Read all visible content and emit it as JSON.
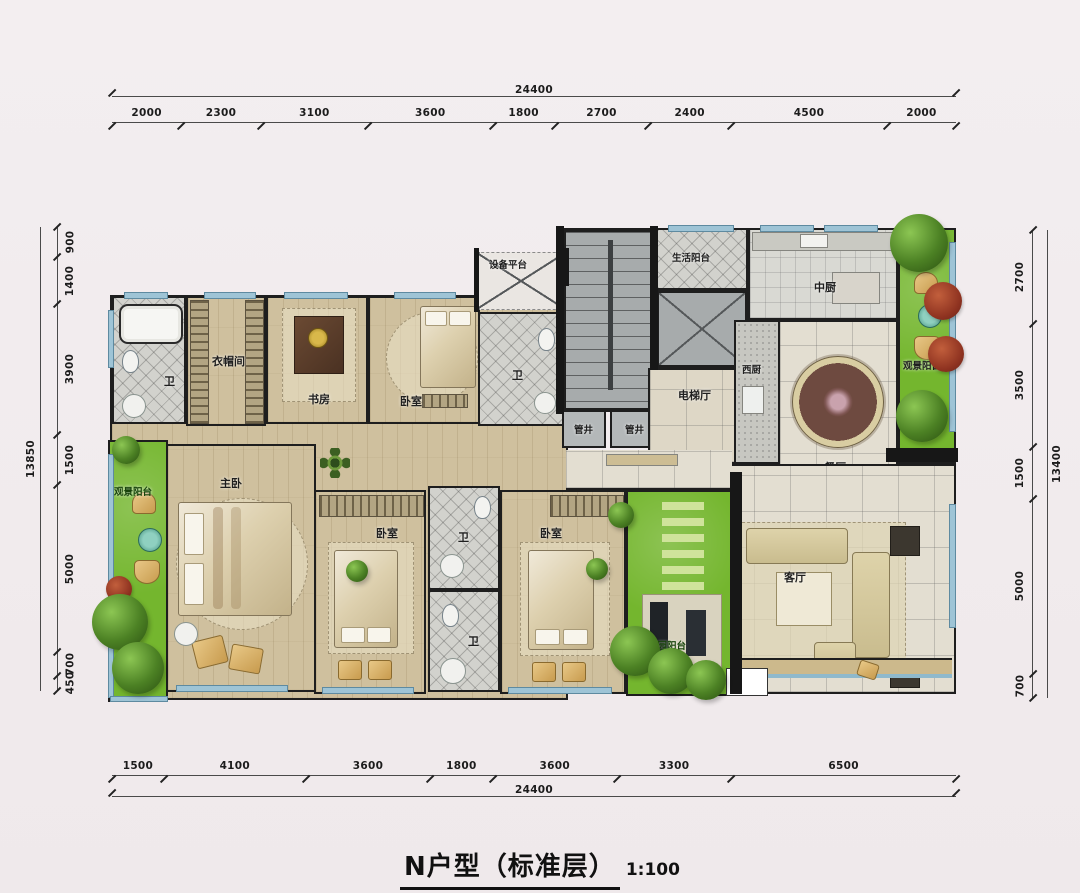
{
  "title": {
    "name": "N户型（标准层）",
    "scale": "1:100"
  },
  "dims": {
    "top": {
      "total": "24400",
      "segs": [
        "2000",
        "2300",
        "3100",
        "3600",
        "1800",
        "2700",
        "2400",
        "4500",
        "2000"
      ]
    },
    "bottom": {
      "total": "24400",
      "segs": [
        "1500",
        "4100",
        "3600",
        "1800",
        "3600",
        "3300",
        "6500"
      ]
    },
    "left": {
      "total": "13850",
      "segs": [
        "900",
        "1400",
        "3900",
        "1500",
        "5000",
        "700",
        "450"
      ]
    },
    "right": {
      "total": "13400",
      "segs": [
        "2700",
        "3500",
        "1500",
        "5000",
        "700"
      ]
    }
  },
  "rooms": {
    "bath1": "卫",
    "cloakroom": "衣帽间",
    "study": "书房",
    "bedroom1": "卧室",
    "equipment": "设备平台",
    "bath2": "卫",
    "service_balcony": "生活阳台",
    "pipe1": "管井",
    "pipe2": "管井",
    "elev_hall": "电梯厅",
    "ckitchen": "中厨",
    "wkitchen": "西厨",
    "dining": "餐厅",
    "view_balcony_r": "观景阳台",
    "master": "主卧",
    "view_balcony_l": "观景阳台",
    "bedroom2": "卧室",
    "bath3": "卫",
    "bedroom3": "卧室",
    "bath4": "卫",
    "garden_balcony": "花园阳台",
    "living": "客厅"
  },
  "colors": {
    "green": "#74b62e",
    "wall": "#171717",
    "window_blue": "#9ec4d6",
    "wood": "#cfc09e",
    "background": "#f1ebed"
  }
}
